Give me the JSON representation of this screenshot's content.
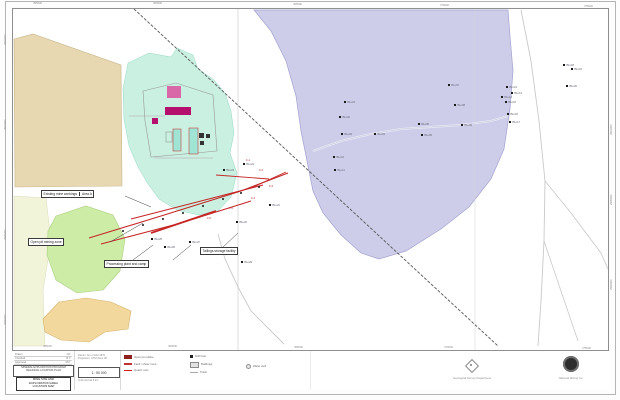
{
  "colors": {
    "lavender": "#cdcdea",
    "lavender_edge": "#a2a2cf",
    "mint": "#c9f0e1",
    "mint_edge": "#97d9c3",
    "tan": "#e7d8b2",
    "tan_edge": "#c8b68c",
    "green": "#cdeca6",
    "green_edge": "#a9cf7f",
    "orange": "#f3d89e",
    "orange_edge": "#d3b26d",
    "paleyellow": "#f2f4da",
    "paleyellow_edge": "#d9dcba",
    "fault": "#c62626",
    "magenta": "#b5106e",
    "teal_building": "#9fe4d4",
    "railway": "#5a5a5a",
    "road": "#c9c9c9"
  },
  "map": {
    "ticks": {
      "top": [
        {
          "x": 33,
          "y": 2,
          "label": "355000"
        },
        {
          "x": 153,
          "y": 2,
          "label": "360000"
        },
        {
          "x": 293,
          "y": 3,
          "label": "365000"
        },
        {
          "x": 440,
          "y": 4,
          "label": "370000"
        },
        {
          "x": 584,
          "y": 5,
          "label": "375000"
        }
      ],
      "bottom": [
        {
          "x": 43,
          "y": 345,
          "label": "355000"
        },
        {
          "x": 168,
          "y": 345,
          "label": "360000"
        },
        {
          "x": 294,
          "y": 346,
          "label": "365000"
        },
        {
          "x": 444,
          "y": 346,
          "label": "370000"
        },
        {
          "x": 582,
          "y": 347,
          "label": "375000"
        }
      ],
      "left": [
        {
          "x": 4,
          "y": 45,
          "label": "2915000"
        },
        {
          "x": 4,
          "y": 130,
          "label": "2910000"
        },
        {
          "x": 4,
          "y": 240,
          "label": "2905000"
        },
        {
          "x": 4,
          "y": 325,
          "label": "2900000"
        }
      ],
      "right": [
        {
          "x": 610,
          "y": 135,
          "label": "2910000"
        },
        {
          "x": 610,
          "y": 205,
          "label": "2905000"
        },
        {
          "x": 610,
          "y": 290,
          "label": "2900000"
        }
      ]
    },
    "markers": [
      {
        "x": 331,
        "y": 92,
        "l": "BH-01"
      },
      {
        "x": 326,
        "y": 107,
        "l": "BH-02"
      },
      {
        "x": 328,
        "y": 124,
        "l": "BH-03"
      },
      {
        "x": 361,
        "y": 124,
        "l": "BH-04"
      },
      {
        "x": 405,
        "y": 114,
        "l": "BH-05"
      },
      {
        "x": 408,
        "y": 125,
        "l": "BH-06"
      },
      {
        "x": 435,
        "y": 75,
        "l": "BH-07"
      },
      {
        "x": 441,
        "y": 95,
        "l": "BH-08"
      },
      {
        "x": 448,
        "y": 115,
        "l": "BH-09"
      },
      {
        "x": 320,
        "y": 147,
        "l": "BH-10"
      },
      {
        "x": 321,
        "y": 160,
        "l": "BH-11"
      },
      {
        "x": 488,
        "y": 87,
        "l": "BH-12"
      },
      {
        "x": 493,
        "y": 77,
        "l": "BH-13"
      },
      {
        "x": 498,
        "y": 83,
        "l": "BH-14"
      },
      {
        "x": 492,
        "y": 92,
        "l": "BH-15"
      },
      {
        "x": 494,
        "y": 104,
        "l": "BH-16"
      },
      {
        "x": 496,
        "y": 112,
        "l": "BH-17"
      },
      {
        "x": 550,
        "y": 55,
        "l": "BH-18"
      },
      {
        "x": 558,
        "y": 59,
        "l": "BH-19"
      },
      {
        "x": 553,
        "y": 76,
        "l": "BH-20"
      },
      {
        "x": 256,
        "y": 195,
        "l": "BH-21"
      },
      {
        "x": 223,
        "y": 212,
        "l": "BH-22"
      },
      {
        "x": 210,
        "y": 160,
        "l": "BH-23"
      },
      {
        "x": 230,
        "y": 154,
        "l": "BH-24"
      },
      {
        "x": 138,
        "y": 229,
        "l": "BH-25"
      },
      {
        "x": 151,
        "y": 237,
        "l": "BH-26"
      },
      {
        "x": 176,
        "y": 232,
        "l": "BH-27"
      },
      {
        "x": 193,
        "y": 240,
        "l": "BH-28"
      },
      {
        "x": 228,
        "y": 252,
        "l": "BH-29"
      }
    ],
    "fault_labels": [
      {
        "x": 233,
        "y": 150,
        "l": "F-1"
      },
      {
        "x": 246,
        "y": 160,
        "l": "F-2"
      },
      {
        "x": 256,
        "y": 176,
        "l": "F-3"
      },
      {
        "x": 238,
        "y": 188,
        "l": "F-4"
      },
      {
        "x": 216,
        "y": 198,
        "l": "F-5"
      },
      {
        "x": 194,
        "y": 208,
        "l": "F-6"
      }
    ],
    "callouts": [
      {
        "x": 28,
        "y": 181,
        "text": "Existing mine workings",
        "cell2": "Area A"
      },
      {
        "x": 15,
        "y": 229,
        "text": "Open pit  mining zone",
        "cell2": ""
      },
      {
        "x": 91,
        "y": 251,
        "text": "Processing plant and camp",
        "cell2": ""
      },
      {
        "x": 187,
        "y": 238,
        "text": "Tailings storage facility",
        "cell2": ""
      }
    ]
  },
  "titleblock": {
    "meta_rows": [
      [
        "Drawn",
        "J.D."
      ],
      [
        "Checked",
        "R.T."
      ],
      [
        "Approved",
        "M.K."
      ],
      [
        "Date",
        "2003"
      ]
    ],
    "box1_lines": [
      "MINERAL EXPLORATION PROGRAM",
      "REGIONAL LOCATION PLAN"
    ],
    "title_lines": [
      "MINE SITE AND",
      "EXPLORATION AREA",
      "LOCATION MAP"
    ],
    "s2_rows": [
      "Datum: Ain el Abd 1970",
      "Projection: UTM Zone 38"
    ],
    "scale": "1 : 50 000",
    "s2_foot": "Grid interval 5 km",
    "legend1": [
      {
        "sym": "pit",
        "label": "Open pit outline"
      },
      {
        "sym": "faultz",
        "label": "Fault / shear zone"
      },
      {
        "sym": "vein",
        "label": "Quartz vein"
      }
    ],
    "legend2": [
      {
        "sym": "drill",
        "label": "Drill hole"
      },
      {
        "sym": "bldg",
        "label": "Buildings"
      },
      {
        "sym": "track",
        "label": "Track"
      }
    ],
    "legend3": [
      {
        "sym": "well",
        "label": "Water well"
      }
    ],
    "logo1_caption": "Geological Survey Department",
    "logo2_caption": "National Mining Co."
  }
}
